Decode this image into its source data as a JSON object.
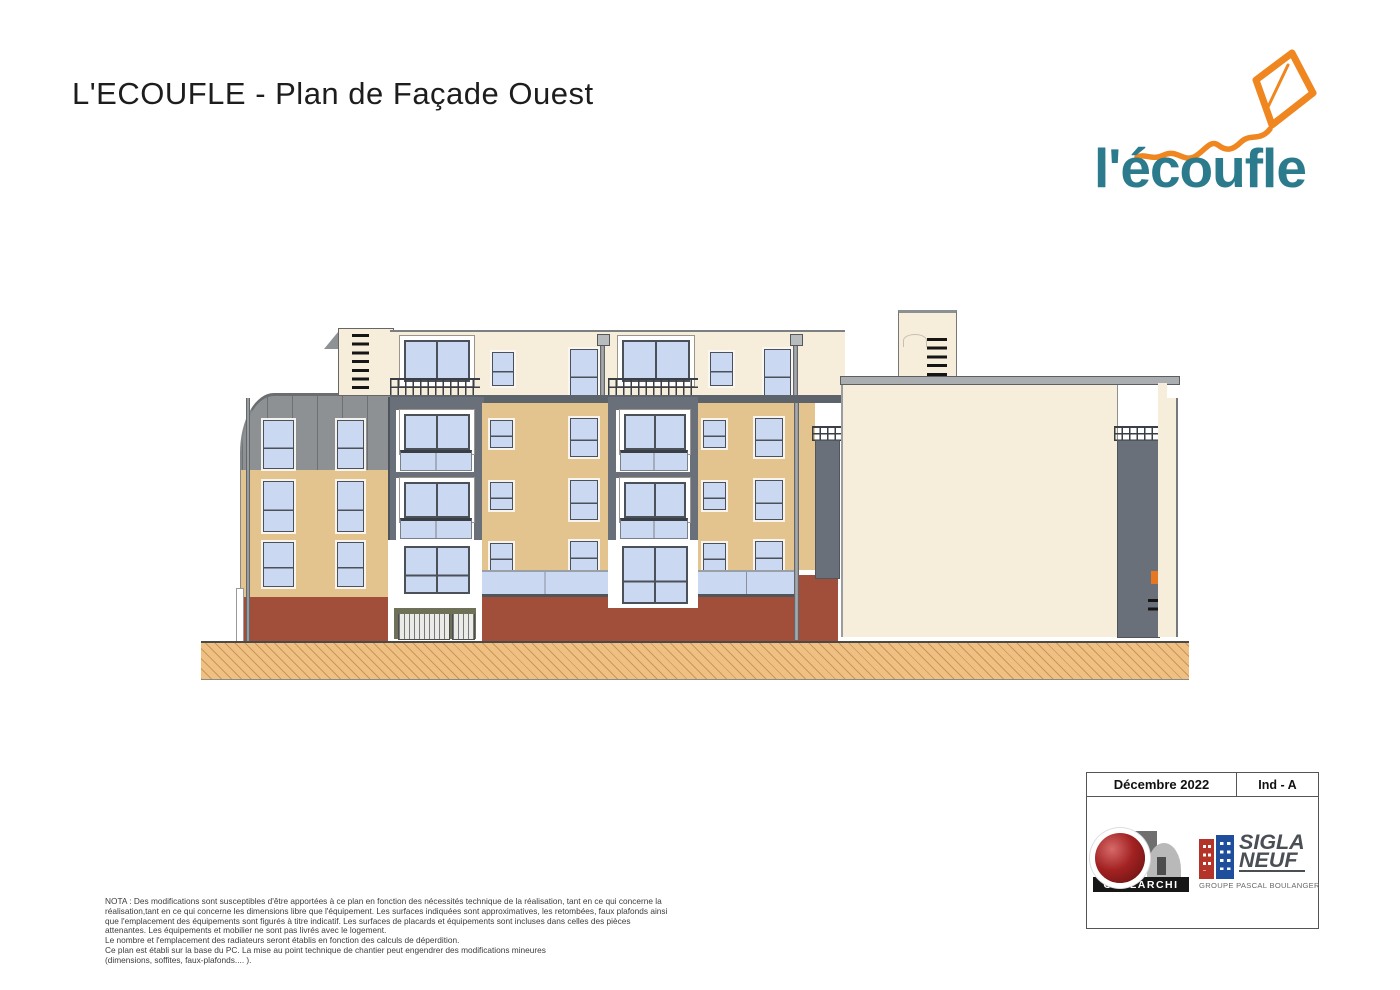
{
  "page": {
    "title": "L'ECOUFLE - Plan de Façade Ouest"
  },
  "logo": {
    "text": "l'écoufle"
  },
  "title_block": {
    "date": "Décembre 2022",
    "index": "Ind - A",
    "opalarchi": "OPALARCHI",
    "sigla_top": "SIGLA",
    "sigla_bottom": "NEUF",
    "sigla_group": "GROUPE PASCAL BOULANGER"
  },
  "nota": {
    "lines": [
      "NOTA : Des modifications sont susceptibles d'être apportées à ce plan en fonction des nécessités technique de la réalisation, tant en ce qui concerne la",
      "réalisation,tant en ce qui concerne les dimensions libre que l'équipement. Les surfaces indiquées sont approximatives, les retombées, faux plafonds ainsi",
      "que l'emplacement des équipements sont figurés à titre indicatif. Les surfaces de placards et équipements sont incluses dans celles des pièces",
      "attenantes. Les équipements et mobilier ne sont pas livrés avec le logement.",
      "Le nombre et l'emplacement des radiateurs seront établis en fonction des calculs de déperdition.",
      "Ce plan est établi sur la base du PC. La mise au point technique de chantier peut engendrer des modifications mineures",
      "(dimensions, soffites, faux-plafonds.... )."
    ]
  },
  "palette": {
    "cream": "#f7eddb",
    "tan": "#e3c48f",
    "brick": "#a14e3a",
    "dark_panel": "#697079",
    "roof_gray": "#8e9193",
    "glass": "#cbd8f2",
    "frame": "#4b5158",
    "ground_fill": "#efc084",
    "ground_line": "#ce9552",
    "accent_orange": "#e87722",
    "logo_teal": "#2b7b8c",
    "logo_orange": "#f0861f"
  }
}
